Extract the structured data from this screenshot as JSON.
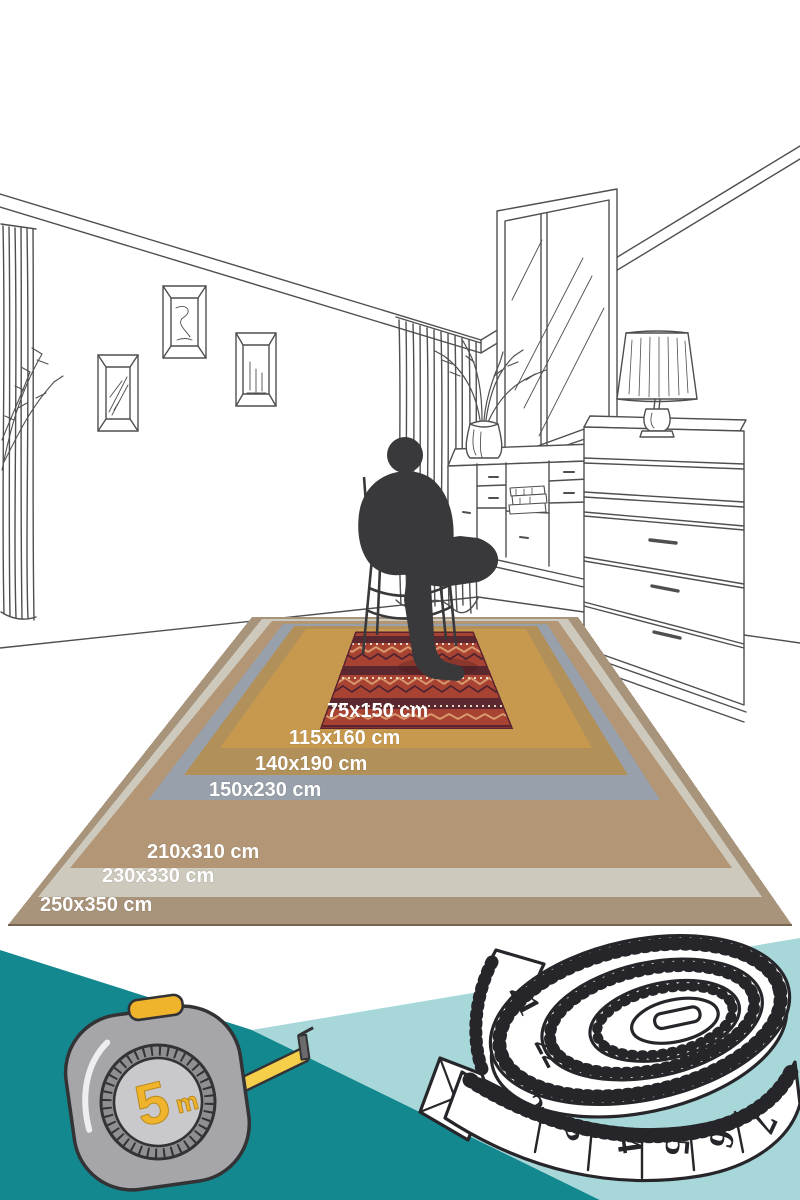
{
  "rug_guide": {
    "sizes": [
      {
        "label": "75x150 cm",
        "color": "#a84334",
        "pattern_dark": "#4f2430",
        "pattern_light": "#d9986b",
        "pattern_dot": "#e9d9c4",
        "border": "#5d2430"
      },
      {
        "label": "115x160 cm",
        "color": "#c6994f"
      },
      {
        "label": "140x190 cm",
        "color": "#b29059"
      },
      {
        "label": "150x230 cm",
        "color": "#97a0ab"
      },
      {
        "label": "210x310 cm",
        "color": "#b29676"
      },
      {
        "label": "230x330 cm",
        "color": "#cdc9bd"
      },
      {
        "label": "250x350 cm",
        "color": "#a8937b"
      }
    ],
    "edge_shadow": "#77634f"
  },
  "illustration": {
    "line_color": "#4f4f51",
    "silhouette_color": "#39393b"
  },
  "footer": {
    "dark_teal": "#13898f",
    "light_teal": "#a7d7d9",
    "tape_measure": {
      "capacity": "5",
      "unit": "m",
      "body_color": "#a6a6aa",
      "ring_color": "#8f8f93",
      "dial_color": "#c9c9cd",
      "accent_color": "#f0b42c",
      "tape_color": "#f5ce4a"
    },
    "sewing_tape": {
      "numbers": [
        "21",
        "22",
        "2",
        "3",
        "4",
        "5",
        "6",
        "7"
      ]
    }
  }
}
